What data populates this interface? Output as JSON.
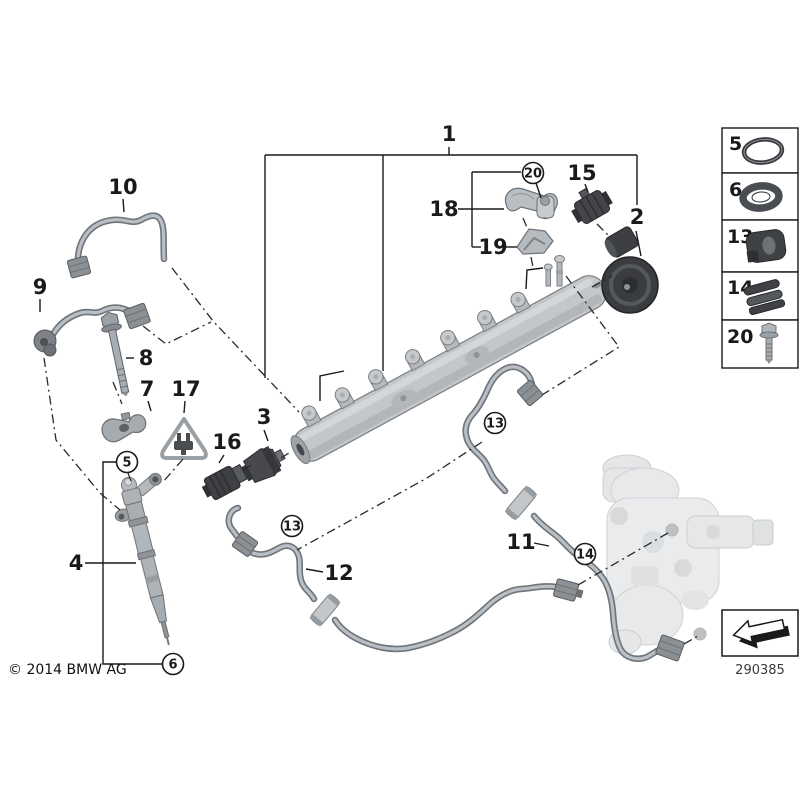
{
  "figure": {
    "copyright": "© 2014 BMW AG",
    "diagram_code": "290385"
  },
  "callouts": {
    "n1": "1",
    "n2": "2",
    "n3": "3",
    "n4": "4",
    "n7": "7",
    "n8": "8",
    "n9": "9",
    "n10": "10",
    "n11": "11",
    "n12": "12",
    "n15": "15",
    "n16": "16",
    "n17": "17",
    "n18": "18",
    "n19": "19",
    "c5": "5",
    "c6": "6",
    "c13a": "13",
    "c13b": "13",
    "c14": "14",
    "c20": "20"
  },
  "legend": {
    "items": [
      {
        "number": "5",
        "icon": "o-ring-icon"
      },
      {
        "number": "6",
        "icon": "seal-ring-icon"
      },
      {
        "number": "13",
        "icon": "rubber-grommet-icon"
      },
      {
        "number": "14",
        "icon": "clip-icon"
      },
      {
        "number": "20",
        "icon": "screw-icon"
      }
    ]
  }
}
